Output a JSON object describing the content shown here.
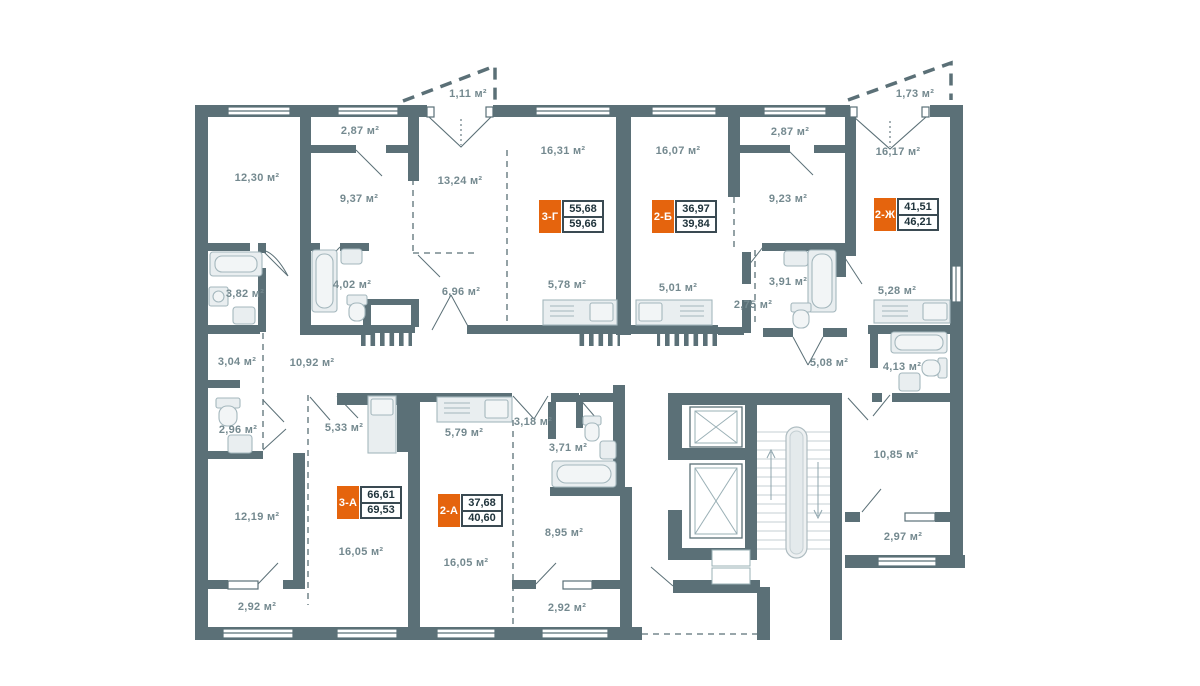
{
  "units": {
    "area_suffix": "м²"
  },
  "colors": {
    "wall": "#5b7077",
    "label_text": "#74898f",
    "badge_orange": "#e5640d",
    "badge_border": "#3a4a52",
    "badge_value_text": "#20343c",
    "fixture_fill": "#e9eef0",
    "fixture_stroke": "#a4b7bd"
  },
  "rooms": [
    {
      "label": "12,30 м²",
      "x": 257,
      "y": 178
    },
    {
      "label": "2,87 м²",
      "x": 360,
      "y": 131
    },
    {
      "label": "9,37 м²",
      "x": 359,
      "y": 199
    },
    {
      "label": "13,24 м²",
      "x": 460,
      "y": 181
    },
    {
      "label": "1,11 м²",
      "x": 468,
      "y": 94
    },
    {
      "label": "16,31 м²",
      "x": 563,
      "y": 151
    },
    {
      "label": "16,07 м²",
      "x": 678,
      "y": 151
    },
    {
      "label": "2,87 м²",
      "x": 790,
      "y": 132
    },
    {
      "label": "9,23 м²",
      "x": 788,
      "y": 199
    },
    {
      "label": "16,17 м²",
      "x": 898,
      "y": 152
    },
    {
      "label": "1,73 м²",
      "x": 915,
      "y": 94
    },
    {
      "label": "3,82 м²",
      "x": 245,
      "y": 294
    },
    {
      "label": "4,02 м²",
      "x": 352,
      "y": 285
    },
    {
      "label": "6,96 м²",
      "x": 461,
      "y": 292
    },
    {
      "label": "5,78 м²",
      "x": 567,
      "y": 285
    },
    {
      "label": "5,01 м²",
      "x": 678,
      "y": 288
    },
    {
      "label": "3,91 м²",
      "x": 788,
      "y": 282
    },
    {
      "label": "2,75 м²",
      "x": 753,
      "y": 305
    },
    {
      "label": "5,28 м²",
      "x": 897,
      "y": 291
    },
    {
      "label": "3,04 м²",
      "x": 237,
      "y": 362
    },
    {
      "label": "10,92 м²",
      "x": 312,
      "y": 363
    },
    {
      "label": "5,08 м²",
      "x": 829,
      "y": 363
    },
    {
      "label": "4,13 м²",
      "x": 902,
      "y": 367
    },
    {
      "label": "2,96 м²",
      "x": 238,
      "y": 430
    },
    {
      "label": "5,33 м²",
      "x": 344,
      "y": 428
    },
    {
      "label": "5,79 м²",
      "x": 464,
      "y": 433
    },
    {
      "label": "3,18 м²",
      "x": 533,
      "y": 422
    },
    {
      "label": "3,71 м²",
      "x": 568,
      "y": 448
    },
    {
      "label": "10,85 м²",
      "x": 896,
      "y": 455
    },
    {
      "label": "12,19 м²",
      "x": 257,
      "y": 517
    },
    {
      "label": "16,05 м²",
      "x": 361,
      "y": 552
    },
    {
      "label": "16,05 м²",
      "x": 466,
      "y": 563
    },
    {
      "label": "8,95 м²",
      "x": 564,
      "y": 533
    },
    {
      "label": "2,92 м²",
      "x": 257,
      "y": 607
    },
    {
      "label": "2,92 м²",
      "x": 567,
      "y": 608
    },
    {
      "label": "2,97 м²",
      "x": 903,
      "y": 537
    }
  ],
  "apartments": [
    {
      "code": "3-Г",
      "value_top": "55,68",
      "value_bottom": "59,66",
      "x": 539,
      "y": 200
    },
    {
      "code": "2-Б",
      "value_top": "36,97",
      "value_bottom": "39,84",
      "x": 652,
      "y": 200
    },
    {
      "code": "2-Ж",
      "value_top": "41,51",
      "value_bottom": "46,21",
      "x": 874,
      "y": 198
    },
    {
      "code": "3-А",
      "value_top": "66,61",
      "value_bottom": "69,53",
      "x": 337,
      "y": 486
    },
    {
      "code": "2-А",
      "value_top": "37,68",
      "value_bottom": "40,60",
      "x": 438,
      "y": 494
    }
  ]
}
